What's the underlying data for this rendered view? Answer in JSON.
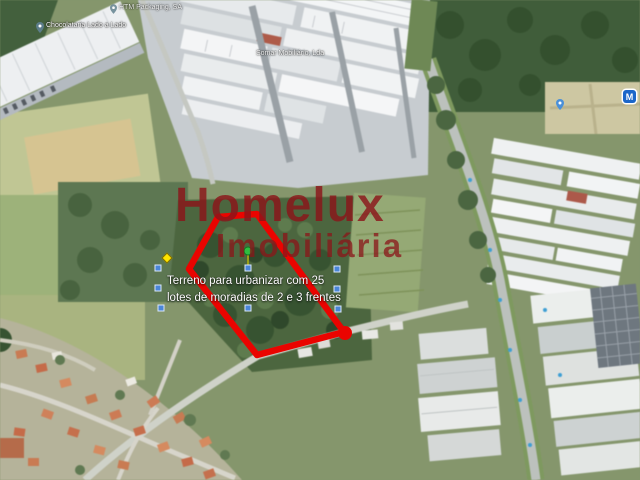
{
  "watermark": {
    "line1": "Homelux",
    "line2": "Imobiliária",
    "color": "#8C161C"
  },
  "caption": {
    "line1": "Terreno para urbanizar com 25",
    "line2": "lotes de moradias de 2 e 3 frentes",
    "color": "#FFFFFF"
  },
  "map_labels": [
    {
      "text": "Chocolataria Lado a Lado"
    },
    {
      "text": "HTM Packaging, SA"
    },
    {
      "text": "Somar Mobiliário, Lda"
    }
  ],
  "transit_badge": {
    "letter": "M",
    "color": "#1B66C9"
  },
  "annotation": {
    "outline_color": "#EA0400",
    "polygon_points": "218,217 257,214 344,332 257,355 189,269",
    "vertex_blob": {
      "x": 345,
      "y": 333,
      "r": 7
    },
    "stem": {
      "x1": 248,
      "y1": 254,
      "x2": 248,
      "y2": 265,
      "color": "#9aa018"
    },
    "markers": [
      {
        "type": "blue-square",
        "x": 158,
        "y": 268
      },
      {
        "type": "blue-square",
        "x": 158,
        "y": 288
      },
      {
        "type": "blue-square",
        "x": 161,
        "y": 308
      },
      {
        "type": "blue-square",
        "x": 248,
        "y": 268
      },
      {
        "type": "blue-square",
        "x": 248,
        "y": 308
      },
      {
        "type": "blue-square",
        "x": 337,
        "y": 269
      },
      {
        "type": "blue-square",
        "x": 337,
        "y": 289
      },
      {
        "type": "blue-square",
        "x": 338,
        "y": 309
      },
      {
        "type": "yellow-diamond",
        "x": 167,
        "y": 258
      },
      {
        "type": "green-vertex",
        "x": 248,
        "y": 251
      }
    ]
  }
}
